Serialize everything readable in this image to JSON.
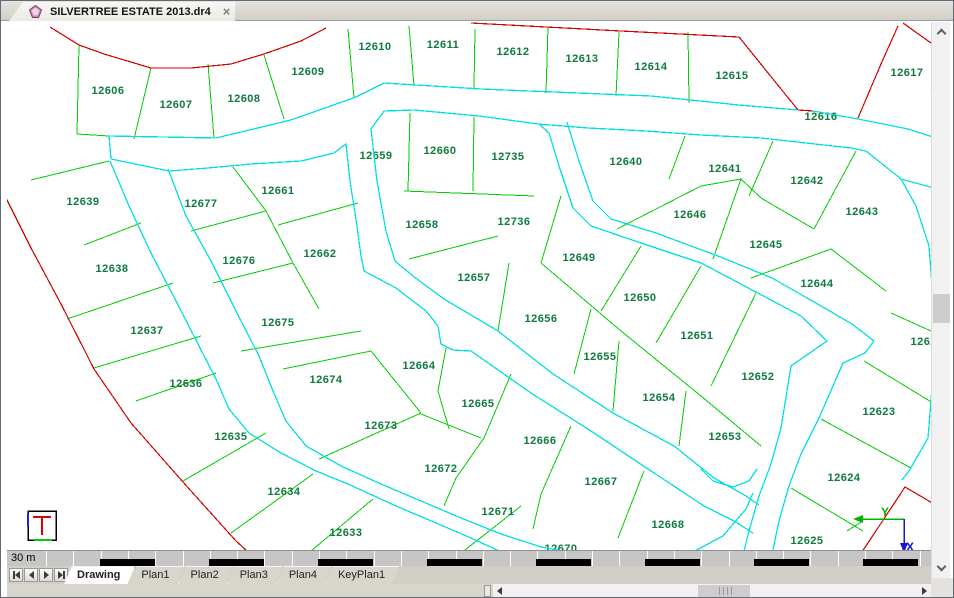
{
  "window": {
    "tab_title": "SILVERTREE ESTATE 2013.dr4",
    "close_glyph": "×"
  },
  "colors": {
    "parcel_line": "#00cf00",
    "road_line": "#00e0e0",
    "boundary_line": "#d40000",
    "label_text": "#0e7a3c",
    "axis_x": "#1616cc",
    "axis_y": "#00b400",
    "legend_red": "#dd0000",
    "legend_blue": "#2222dd",
    "legend_green": "#00cf00"
  },
  "scalebar": {
    "label": "30 m"
  },
  "sheet_tabs": {
    "active": "Drawing",
    "tabs": [
      "Drawing",
      "Plan1",
      "Plan2",
      "Plan3",
      "Plan4",
      "KeyPlan1"
    ]
  },
  "drawing": {
    "axis": {
      "x_label": "X",
      "y_label": "Y"
    },
    "lot_labels": [
      [
        "12606",
        107,
        90
      ],
      [
        "12607",
        175,
        104
      ],
      [
        "12608",
        243,
        98
      ],
      [
        "12609",
        307,
        71
      ],
      [
        "12610",
        374,
        46
      ],
      [
        "12611",
        442,
        44
      ],
      [
        "12612",
        512,
        51
      ],
      [
        "12613",
        581,
        58
      ],
      [
        "12614",
        650,
        66
      ],
      [
        "12615",
        731,
        75
      ],
      [
        "12616",
        820,
        116
      ],
      [
        "12617",
        906,
        72
      ],
      [
        "12622",
        926,
        341
      ],
      [
        "12623",
        878,
        411
      ],
      [
        "12624",
        843,
        477
      ],
      [
        "12625",
        806,
        540
      ],
      [
        "12633",
        345,
        532
      ],
      [
        "12634",
        283,
        491
      ],
      [
        "12635",
        230,
        436
      ],
      [
        "12636",
        185,
        383
      ],
      [
        "12637",
        146,
        330
      ],
      [
        "12638",
        111,
        268
      ],
      [
        "12639",
        82,
        201
      ],
      [
        "12640",
        625,
        161
      ],
      [
        "12641",
        724,
        168
      ],
      [
        "12642",
        806,
        180
      ],
      [
        "12643",
        861,
        211
      ],
      [
        "12644",
        816,
        283
      ],
      [
        "12645",
        765,
        244
      ],
      [
        "12646",
        689,
        214
      ],
      [
        "12649",
        578,
        257
      ],
      [
        "12650",
        639,
        297
      ],
      [
        "12651",
        696,
        335
      ],
      [
        "12652",
        757,
        376
      ],
      [
        "12653",
        724,
        436
      ],
      [
        "12654",
        658,
        397
      ],
      [
        "12655",
        599,
        356
      ],
      [
        "12656",
        540,
        318
      ],
      [
        "12657",
        473,
        277
      ],
      [
        "12658",
        421,
        224
      ],
      [
        "12659",
        375,
        155
      ],
      [
        "12660",
        439,
        150
      ],
      [
        "12661",
        277,
        190
      ],
      [
        "12662",
        319,
        253
      ],
      [
        "12664",
        418,
        365
      ],
      [
        "12665",
        477,
        403
      ],
      [
        "12666",
        539,
        440
      ],
      [
        "12667",
        600,
        481
      ],
      [
        "12668",
        667,
        524
      ],
      [
        "12670",
        560,
        548
      ],
      [
        "12671",
        497,
        511
      ],
      [
        "12672",
        440,
        468
      ],
      [
        "12673",
        380,
        425
      ],
      [
        "12674",
        325,
        379
      ],
      [
        "12675",
        277,
        322
      ],
      [
        "12676",
        238,
        260
      ],
      [
        "12677",
        200,
        203
      ],
      [
        "12735",
        507,
        156
      ],
      [
        "12736",
        513,
        221
      ]
    ],
    "roads": [
      [
        [
          108,
          135
        ],
        [
          215,
          137
        ],
        [
          290,
          119
        ],
        [
          355,
          96
        ],
        [
          383,
          82
        ],
        [
          480,
          88
        ],
        [
          650,
          95
        ],
        [
          738,
          104
        ],
        [
          797,
          109
        ]
      ],
      [
        [
          812,
          110
        ],
        [
          857,
          118
        ],
        [
          907,
          128
        ],
        [
          954,
          143
        ]
      ],
      [
        [
          108,
          135
        ],
        [
          110,
          158
        ]
      ],
      [
        [
          110,
          158
        ],
        [
          168,
          170
        ],
        [
          207,
          167
        ],
        [
          250,
          163
        ],
        [
          300,
          160
        ],
        [
          333,
          152
        ],
        [
          345,
          143
        ],
        [
          349,
          180
        ],
        [
          356,
          225
        ],
        [
          360,
          255
        ],
        [
          363,
          270
        ],
        [
          395,
          287
        ],
        [
          425,
          310
        ],
        [
          437,
          325
        ],
        [
          440,
          343
        ],
        [
          452,
          349
        ],
        [
          470,
          350
        ],
        [
          530,
          392
        ],
        [
          590,
          430
        ],
        [
          647,
          468
        ],
        [
          703,
          505
        ],
        [
          733,
          520
        ],
        [
          752,
          532
        ]
      ],
      [
        [
          370,
          128
        ],
        [
          383,
          110
        ],
        [
          413,
          109
        ],
        [
          478,
          115
        ],
        [
          537,
          123
        ]
      ],
      [
        [
          370,
          128
        ],
        [
          376,
          180
        ],
        [
          385,
          230
        ],
        [
          394,
          260
        ],
        [
          412,
          275
        ],
        [
          443,
          298
        ],
        [
          497,
          330
        ],
        [
          552,
          373
        ],
        [
          612,
          412
        ],
        [
          673,
          445
        ],
        [
          713,
          477
        ],
        [
          745,
          495
        ],
        [
          758,
          504
        ]
      ],
      [
        [
          538,
          123
        ],
        [
          548,
          132
        ],
        [
          558,
          165
        ],
        [
          572,
          207
        ],
        [
          590,
          225
        ],
        [
          640,
          242
        ],
        [
          700,
          262
        ],
        [
          753,
          290
        ],
        [
          800,
          315
        ],
        [
          826,
          340
        ],
        [
          800,
          358
        ],
        [
          790,
          365
        ],
        [
          780,
          427
        ],
        [
          770,
          463
        ],
        [
          758,
          495
        ],
        [
          748,
          530
        ],
        [
          741,
          558
        ]
      ],
      [
        [
          566,
          121
        ],
        [
          578,
          160
        ],
        [
          592,
          200
        ],
        [
          610,
          218
        ],
        [
          655,
          232
        ],
        [
          717,
          255
        ],
        [
          771,
          277
        ],
        [
          820,
          305
        ],
        [
          851,
          323
        ],
        [
          873,
          340
        ],
        [
          864,
          352
        ],
        [
          842,
          362
        ],
        [
          818,
          417
        ],
        [
          800,
          453
        ],
        [
          788,
          485
        ],
        [
          778,
          520
        ],
        [
          770,
          558
        ]
      ],
      [
        [
          537,
          123
        ],
        [
          587,
          127
        ],
        [
          645,
          130
        ],
        [
          700,
          134
        ],
        [
          760,
          137
        ],
        [
          850,
          147
        ],
        [
          865,
          150
        ],
        [
          900,
          178
        ],
        [
          933,
          187
        ],
        [
          954,
          192
        ]
      ],
      [
        [
          900,
          178
        ],
        [
          915,
          205
        ],
        [
          928,
          245
        ],
        [
          933,
          310
        ],
        [
          933,
          357
        ],
        [
          930,
          400
        ],
        [
          927,
          437
        ],
        [
          908,
          470
        ],
        [
          901,
          479
        ]
      ],
      [
        [
          167,
          168
        ],
        [
          185,
          215
        ],
        [
          210,
          260
        ],
        [
          235,
          310
        ],
        [
          258,
          355
        ],
        [
          272,
          390
        ],
        [
          285,
          420
        ],
        [
          305,
          445
        ],
        [
          340,
          465
        ],
        [
          380,
          483
        ],
        [
          420,
          500
        ],
        [
          460,
          517
        ],
        [
          500,
          533
        ],
        [
          540,
          546
        ],
        [
          585,
          554
        ],
        [
          640,
          558
        ],
        [
          690,
          552
        ],
        [
          722,
          535
        ],
        [
          745,
          508
        ],
        [
          752,
          492
        ]
      ],
      [
        [
          109,
          160
        ],
        [
          128,
          205
        ],
        [
          150,
          252
        ],
        [
          175,
          300
        ],
        [
          198,
          345
        ],
        [
          215,
          378
        ],
        [
          228,
          408
        ],
        [
          248,
          432
        ],
        [
          280,
          452
        ],
        [
          315,
          470
        ],
        [
          347,
          483
        ],
        [
          395,
          505
        ],
        [
          435,
          522
        ],
        [
          470,
          537
        ],
        [
          505,
          553
        ],
        [
          520,
          560
        ]
      ],
      [
        [
          700,
          468
        ],
        [
          712,
          480
        ],
        [
          732,
          486
        ],
        [
          748,
          480
        ],
        [
          756,
          468
        ]
      ]
    ],
    "boundary": [
      [
        [
          49,
          26
        ],
        [
          78,
          44
        ],
        [
          103,
          53
        ],
        [
          150,
          67
        ],
        [
          190,
          67
        ],
        [
          230,
          63
        ],
        [
          263,
          53
        ],
        [
          300,
          40
        ],
        [
          325,
          27
        ]
      ],
      [
        [
          470,
          22
        ],
        [
          620,
          30
        ],
        [
          738,
          36
        ],
        [
          797,
          109
        ],
        [
          812,
          110
        ]
      ],
      [
        [
          857,
          117
        ],
        [
          880,
          63
        ],
        [
          897,
          25
        ]
      ],
      [
        [
          902,
          22
        ],
        [
          930,
          42
        ],
        [
          954,
          58
        ]
      ],
      [
        [
          4,
          195
        ],
        [
          30,
          247
        ],
        [
          60,
          303
        ],
        [
          93,
          368
        ],
        [
          130,
          422
        ],
        [
          190,
          490
        ],
        [
          235,
          540
        ],
        [
          258,
          561
        ]
      ],
      [
        [
          857,
          557
        ],
        [
          904,
          486
        ],
        [
          933,
          503
        ],
        [
          954,
          512
        ]
      ]
    ],
    "parcel_lines": [
      [
        78,
        44,
        76,
        133
      ],
      [
        76,
        133,
        108,
        135
      ],
      [
        150,
        67,
        133,
        138
      ],
      [
        207,
        63,
        213,
        137
      ],
      [
        263,
        54,
        283,
        118
      ],
      [
        347,
        28,
        353,
        97
      ],
      [
        408,
        25,
        413,
        85
      ],
      [
        474,
        28,
        473,
        87
      ],
      [
        547,
        26,
        545,
        92
      ],
      [
        618,
        31,
        615,
        95
      ],
      [
        687,
        31,
        688,
        102
      ],
      [
        30,
        179,
        108,
        160
      ],
      [
        83,
        244,
        140,
        222
      ],
      [
        66,
        318,
        172,
        282
      ],
      [
        93,
        367,
        200,
        335
      ],
      [
        135,
        400,
        215,
        372
      ],
      [
        182,
        480,
        265,
        432
      ],
      [
        230,
        532,
        312,
        473
      ],
      [
        298,
        560,
        372,
        498
      ],
      [
        450,
        560,
        520,
        505
      ],
      [
        232,
        166,
        265,
        210
      ],
      [
        265,
        210,
        292,
        262
      ],
      [
        292,
        262,
        318,
        308
      ],
      [
        277,
        224,
        357,
        202
      ],
      [
        190,
        230,
        265,
        210
      ],
      [
        212,
        282,
        292,
        262
      ],
      [
        240,
        350,
        360,
        330
      ],
      [
        282,
        368,
        370,
        350
      ],
      [
        370,
        350,
        420,
        412
      ],
      [
        318,
        458,
        420,
        412
      ],
      [
        445,
        347,
        437,
        390
      ],
      [
        437,
        390,
        448,
        428
      ],
      [
        420,
        413,
        480,
        437
      ],
      [
        510,
        373,
        483,
        437
      ],
      [
        483,
        437,
        455,
        477
      ],
      [
        455,
        477,
        443,
        505
      ],
      [
        570,
        425,
        540,
        493
      ],
      [
        540,
        493,
        532,
        528
      ],
      [
        643,
        470,
        617,
        537
      ],
      [
        497,
        235,
        408,
        258
      ],
      [
        508,
        262,
        497,
        330
      ],
      [
        590,
        308,
        573,
        373
      ],
      [
        618,
        340,
        612,
        410
      ],
      [
        685,
        390,
        678,
        445
      ],
      [
        403,
        190,
        533,
        195
      ],
      [
        409,
        112,
        407,
        190
      ],
      [
        473,
        116,
        472,
        190
      ],
      [
        560,
        195,
        540,
        262
      ],
      [
        540,
        262,
        620,
        330
      ],
      [
        620,
        330,
        700,
        395
      ],
      [
        700,
        395,
        760,
        445
      ],
      [
        640,
        245,
        600,
        310
      ],
      [
        700,
        265,
        655,
        342
      ],
      [
        755,
        292,
        710,
        385
      ],
      [
        684,
        135,
        668,
        178
      ],
      [
        616,
        228,
        700,
        185
      ],
      [
        700,
        185,
        740,
        178
      ],
      [
        772,
        140,
        748,
        195
      ],
      [
        740,
        178,
        760,
        197
      ],
      [
        760,
        197,
        813,
        228
      ],
      [
        855,
        150,
        813,
        228
      ],
      [
        740,
        178,
        712,
        258
      ],
      [
        750,
        277,
        830,
        248
      ],
      [
        830,
        248,
        885,
        290
      ],
      [
        863,
        360,
        932,
        402
      ],
      [
        820,
        418,
        910,
        467
      ],
      [
        790,
        487,
        862,
        530
      ],
      [
        890,
        312,
        930,
        330
      ],
      [
        930,
        87,
        942,
        117
      ],
      [
        846,
        530,
        862,
        520
      ]
    ]
  }
}
